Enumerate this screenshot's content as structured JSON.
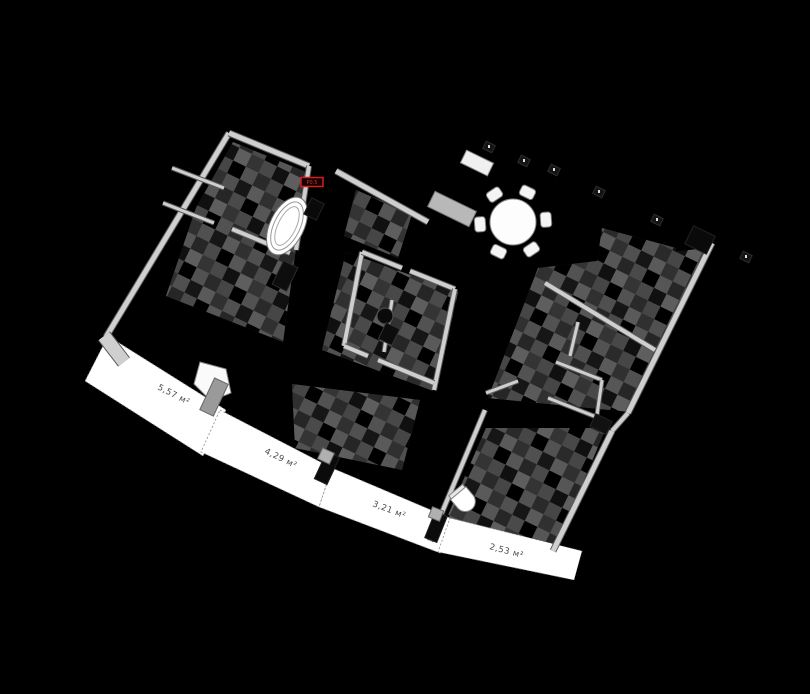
{
  "scene": {
    "width": 810,
    "height": 694,
    "background": "#000000",
    "wall_color": "#cfcfcf",
    "wall_edge_color": "#5a5a5a",
    "floor_base_color": "#383838",
    "balcony_color": "#ffffff",
    "label_color": "#4a4a4a",
    "accent_red": "#d21f1f"
  },
  "badge": {
    "text": "P0.5",
    "x": 312,
    "y": 182,
    "w": 22,
    "h": 9
  },
  "balconies": [
    {
      "label": "5,57 м²",
      "lx": 157,
      "ly": 389,
      "rot": 27,
      "points": [
        [
          108,
          336
        ],
        [
          226,
          410
        ],
        [
          203,
          456
        ],
        [
          85,
          381
        ]
      ]
    },
    {
      "label": "4,29 м²",
      "lx": 264,
      "ly": 453,
      "rot": 26,
      "points": [
        [
          220,
          410
        ],
        [
          332,
          468
        ],
        [
          319,
          507
        ],
        [
          201,
          452
        ]
      ]
    },
    {
      "label": "3,21 м²",
      "lx": 372,
      "ly": 506,
      "rot": 21,
      "points": [
        [
          332,
          468
        ],
        [
          450,
          518
        ],
        [
          440,
          553
        ],
        [
          319,
          507
        ]
      ]
    },
    {
      "label": "2,53 м²",
      "lx": 489,
      "ly": 549,
      "rot": 15,
      "points": [
        [
          450,
          518
        ],
        [
          582,
          551
        ],
        [
          574,
          580
        ],
        [
          438,
          552
        ]
      ]
    }
  ],
  "rooms": [
    {
      "name": "room-top-left",
      "points": [
        [
          233,
          142
        ],
        [
          306,
          172
        ],
        [
          296,
          248
        ],
        [
          283,
          342
        ],
        [
          166,
          296
        ],
        [
          196,
          208
        ]
      ]
    },
    {
      "name": "room-mid-bath",
      "points": [
        [
          346,
          252
        ],
        [
          458,
          292
        ],
        [
          436,
          392
        ],
        [
          322,
          350
        ]
      ]
    },
    {
      "name": "room-right",
      "points": [
        [
          538,
          268
        ],
        [
          706,
          248
        ],
        [
          630,
          412
        ],
        [
          488,
          398
        ]
      ]
    },
    {
      "name": "room-bottom-right",
      "points": [
        [
          486,
          428
        ],
        [
          606,
          428
        ],
        [
          556,
          546
        ],
        [
          438,
          538
        ]
      ]
    },
    {
      "name": "room-sofa",
      "points": [
        [
          292,
          384
        ],
        [
          420,
          400
        ],
        [
          402,
          470
        ],
        [
          295,
          448
        ]
      ]
    },
    {
      "name": "room-near-dining",
      "points": [
        [
          602,
          228
        ],
        [
          676,
          248
        ],
        [
          658,
          316
        ],
        [
          592,
          296
        ]
      ]
    },
    {
      "name": "room-top-middle",
      "points": [
        [
          356,
          190
        ],
        [
          412,
          214
        ],
        [
          398,
          258
        ],
        [
          344,
          236
        ]
      ]
    }
  ],
  "walls": [
    {
      "x1": 229,
      "y1": 133,
      "x2": 106,
      "y2": 337,
      "w": 5
    },
    {
      "x1": 104,
      "y1": 336,
      "x2": 124,
      "y2": 362,
      "w": 13
    },
    {
      "x1": 229,
      "y1": 133,
      "x2": 309,
      "y2": 166,
      "w": 5
    },
    {
      "x1": 336,
      "y1": 171,
      "x2": 428,
      "y2": 222,
      "w": 5
    },
    {
      "x1": 712,
      "y1": 243,
      "x2": 628,
      "y2": 413,
      "w": 5
    },
    {
      "x1": 628,
      "y1": 413,
      "x2": 612,
      "y2": 431,
      "w": 4
    },
    {
      "x1": 612,
      "y1": 431,
      "x2": 553,
      "y2": 551,
      "w": 5
    },
    {
      "x1": 485,
      "y1": 410,
      "x2": 430,
      "y2": 541,
      "w": 4
    },
    {
      "x1": 309,
      "y1": 166,
      "x2": 296,
      "y2": 250,
      "w": 4
    },
    {
      "x1": 232,
      "y1": 229,
      "x2": 290,
      "y2": 253,
      "w": 4
    },
    {
      "x1": 172,
      "y1": 168,
      "x2": 224,
      "y2": 188,
      "w": 3
    },
    {
      "x1": 163,
      "y1": 203,
      "x2": 214,
      "y2": 223,
      "w": 3
    },
    {
      "x1": 362,
      "y1": 252,
      "x2": 344,
      "y2": 346,
      "w": 4
    },
    {
      "x1": 362,
      "y1": 252,
      "x2": 402,
      "y2": 268,
      "w": 4
    },
    {
      "x1": 410,
      "y1": 271,
      "x2": 455,
      "y2": 289,
      "w": 4
    },
    {
      "x1": 455,
      "y1": 289,
      "x2": 434,
      "y2": 390,
      "w": 4
    },
    {
      "x1": 344,
      "y1": 346,
      "x2": 368,
      "y2": 356,
      "w": 4
    },
    {
      "x1": 378,
      "y1": 360,
      "x2": 434,
      "y2": 383,
      "w": 4
    },
    {
      "x1": 392,
      "y1": 300,
      "x2": 384,
      "y2": 352,
      "w": 3
    },
    {
      "x1": 545,
      "y1": 283,
      "x2": 655,
      "y2": 350,
      "w": 4
    },
    {
      "x1": 578,
      "y1": 322,
      "x2": 570,
      "y2": 356,
      "w": 3
    },
    {
      "x1": 556,
      "y1": 362,
      "x2": 602,
      "y2": 380,
      "w": 3
    },
    {
      "x1": 548,
      "y1": 398,
      "x2": 604,
      "y2": 420,
      "w": 3
    },
    {
      "x1": 602,
      "y1": 380,
      "x2": 596,
      "y2": 422,
      "w": 3
    },
    {
      "x1": 486,
      "y1": 393,
      "x2": 518,
      "y2": 381,
      "w": 3
    }
  ],
  "furniture": [
    {
      "type": "rings",
      "name": "bathtub",
      "x": 287,
      "y": 226,
      "rx": 17,
      "ry": 31,
      "rot": 26
    },
    {
      "type": "dining",
      "name": "dining-table",
      "x": 513,
      "y": 222,
      "r": 23,
      "chairDist": 33,
      "chairW": 15,
      "chairH": 11,
      "angles": [
        -64,
        -4,
        56,
        116,
        176,
        236
      ]
    },
    {
      "type": "rect",
      "name": "kitchen-counter",
      "x": 477,
      "y": 163,
      "w": 30,
      "h": 14,
      "rot": 26,
      "fill": "#f0f0f0",
      "stroke": "#888888"
    },
    {
      "type": "rect",
      "name": "kitchen-island",
      "x": 452,
      "y": 209,
      "w": 46,
      "h": 17,
      "rot": 26,
      "fill": "#b8b8b8",
      "stroke": "#777777"
    },
    {
      "type": "rect",
      "name": "door-block",
      "x": 285,
      "y": 276,
      "w": 16,
      "h": 26,
      "rot": 26,
      "fill": "#0d0d0d",
      "stroke": "#2a2a2a"
    },
    {
      "type": "rect",
      "name": "door-block",
      "x": 314,
      "y": 209,
      "w": 14,
      "h": 18,
      "rot": 26,
      "fill": "#0a0a0a",
      "stroke": "#222222"
    },
    {
      "type": "rect",
      "name": "corner-block",
      "x": 700,
      "y": 240,
      "w": 24,
      "h": 20,
      "rot": 26,
      "fill": "#0a0a0a",
      "stroke": "#222222"
    },
    {
      "type": "rect",
      "name": "corner-block",
      "x": 601,
      "y": 424,
      "w": 18,
      "h": 14,
      "rot": 26,
      "fill": "#111111",
      "stroke": "#222222"
    },
    {
      "type": "circle",
      "name": "round-sink",
      "x": 385,
      "y": 316,
      "r": 8,
      "fill": "#0a0a0a",
      "stroke": "#555555"
    },
    {
      "type": "rect",
      "name": "wc-dark",
      "x": 389,
      "y": 334,
      "w": 15,
      "h": 18,
      "rot": 26,
      "fill": "#0c0c0c",
      "stroke": "#333333"
    },
    {
      "type": "toilet",
      "name": "toilet",
      "x": 464,
      "y": 500,
      "rot": 205
    },
    {
      "type": "poly",
      "name": "planter",
      "points": [
        [
          200,
          362
        ],
        [
          226,
          369
        ],
        [
          231,
          393
        ],
        [
          211,
          401
        ],
        [
          194,
          384
        ]
      ],
      "fill": "#fafafa",
      "stroke": "#888888"
    },
    {
      "type": "rect",
      "name": "balcony-divider",
      "x": 214,
      "y": 397,
      "w": 15,
      "h": 35,
      "rot": 25,
      "fill": "#9a9a9a",
      "stroke": "#666666"
    },
    {
      "type": "rect",
      "name": "balcony-divider",
      "x": 327,
      "y": 468,
      "w": 14,
      "h": 30,
      "rot": 25,
      "fill": "#0b0b0b",
      "stroke": "#222222"
    },
    {
      "type": "rect",
      "name": "balcony-divider-cap",
      "x": 326,
      "y": 456,
      "w": 13,
      "h": 12,
      "rot": 25,
      "fill": "#b0b0b0",
      "stroke": "#666666"
    },
    {
      "type": "rect",
      "name": "balcony-divider",
      "x": 436,
      "y": 527,
      "w": 13,
      "h": 28,
      "rot": 22,
      "fill": "#0b0b0b",
      "stroke": "#222222"
    },
    {
      "type": "rect",
      "name": "balcony-divider-cap",
      "x": 436,
      "y": 514,
      "w": 12,
      "h": 11,
      "rot": 22,
      "fill": "#b0b0b0",
      "stroke": "#666666"
    },
    {
      "type": "dot",
      "name": "small-object",
      "x": 489,
      "y": 147
    },
    {
      "type": "dot",
      "name": "small-object",
      "x": 524,
      "y": 161
    },
    {
      "type": "dot",
      "name": "small-object",
      "x": 554,
      "y": 170
    },
    {
      "type": "dot",
      "name": "small-object",
      "x": 599,
      "y": 192
    },
    {
      "type": "dot",
      "name": "small-object",
      "x": 657,
      "y": 220
    },
    {
      "type": "dot",
      "name": "small-object",
      "x": 746,
      "y": 257
    }
  ]
}
